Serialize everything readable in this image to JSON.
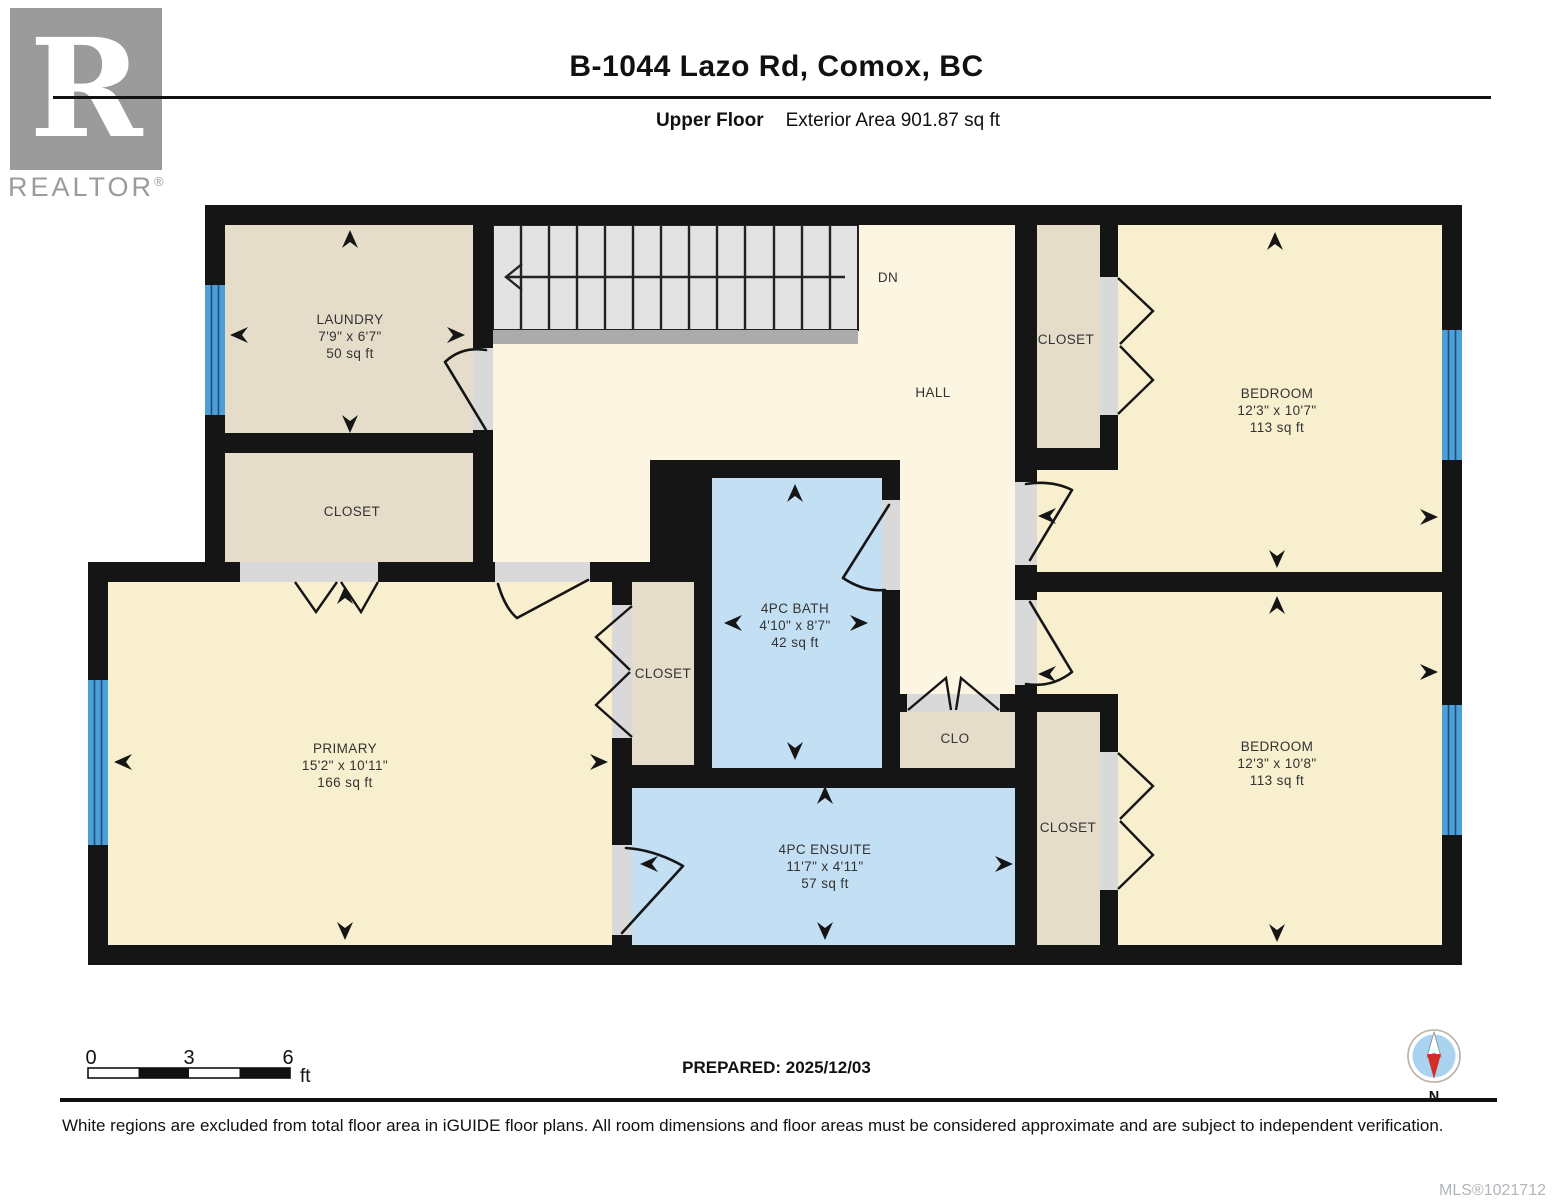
{
  "header": {
    "title": "B-1044 Lazo Rd, Comox, BC",
    "floor_label": "Upper Floor",
    "area_label": "Exterior Area 901.87 sq ft"
  },
  "logo": {
    "letter": "R",
    "brand": "REALTOR",
    "registered": "®"
  },
  "rooms": {
    "laundry": {
      "name": "LAUNDRY",
      "dims": "7'9\" x 6'7\"",
      "area": "50 sq ft"
    },
    "closet_laundry": {
      "name": "CLOSET"
    },
    "hall": {
      "name": "HALL"
    },
    "stairs": {
      "direction_label": "DN"
    },
    "closet_top_right": {
      "name": "CLOSET"
    },
    "bedroom_top": {
      "name": "BEDROOM",
      "dims": "12'3\" x 10'7\"",
      "area": "113 sq ft"
    },
    "bath": {
      "name": "4PC BATH",
      "dims": "4'10\" x 8'7\"",
      "area": "42 sq ft"
    },
    "closet_central": {
      "name": "CLOSET"
    },
    "clo": {
      "name": "CLO"
    },
    "primary": {
      "name": "PRIMARY",
      "dims": "15'2\" x 10'11\"",
      "area": "166 sq ft"
    },
    "ensuite": {
      "name": "4PC ENSUITE",
      "dims": "11'7\" x 4'11\"",
      "area": "57 sq ft"
    },
    "closet_bottom_right": {
      "name": "CLOSET"
    },
    "bedroom_bottom": {
      "name": "BEDROOM",
      "dims": "12'3\" x 10'8\"",
      "area": "113 sq ft"
    }
  },
  "scale_bar": {
    "tick_0": "0",
    "tick_3": "3",
    "tick_6": "6",
    "unit": "ft"
  },
  "prepared_label": "PREPARED: 2025/12/03",
  "compass": {
    "north_label": "N"
  },
  "footer": {
    "disclaimer": "White regions are excluded from total floor area in iGUIDE floor plans. All room dimensions and floor areas must be considered approximate and are subject to independent verification.",
    "mls": "MLS®1021712"
  },
  "colors": {
    "wall": "#151515",
    "room_yellow": "#f8efcf",
    "hall_yellow": "#fcf5e1",
    "room_tan": "#e5ddca",
    "room_blue": "#c2dff4",
    "window_blue": "#4d9fd8",
    "stair_tread": "#e3e3e3",
    "stair_landing": "#ababab",
    "door_opening": "#d9d9d9",
    "compass_disc": "#a9d3ee",
    "compass_south": "#d32d26",
    "logo_gray": "#9b9b9b",
    "mls_gray": "#b0b5ba"
  }
}
